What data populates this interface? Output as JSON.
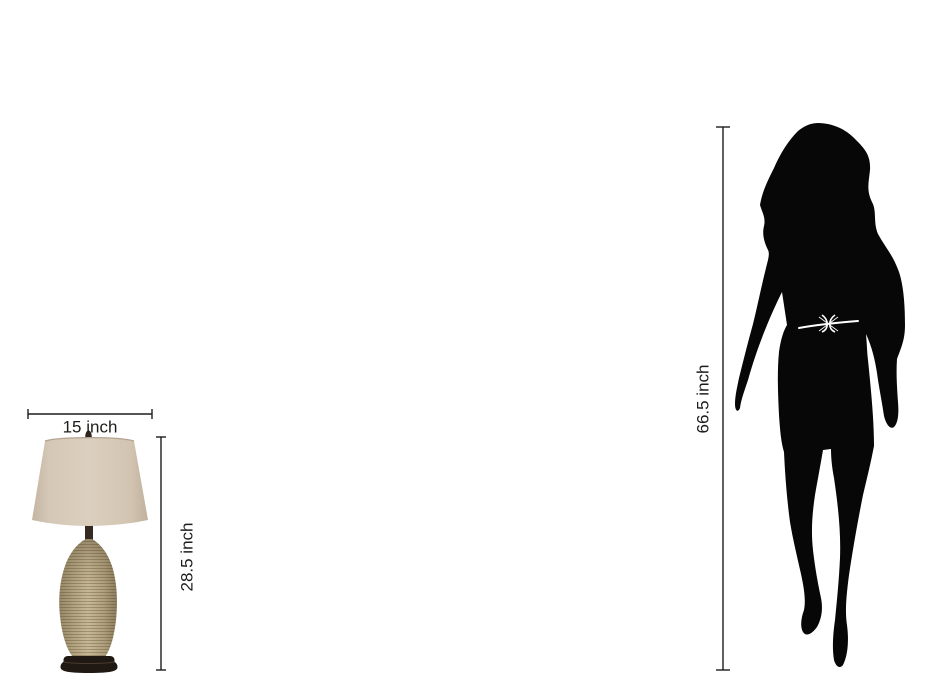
{
  "objects": {
    "lamp": {
      "name": "table-lamp"
    },
    "person": {
      "name": "woman-silhouette"
    }
  },
  "dimensions": {
    "lamp_width": "15 inch",
    "lamp_height": "28.5 inch",
    "person_height": "66.5 inch"
  },
  "colors": {
    "background": "#ffffff",
    "line": "#1d1d1b",
    "text": "#1d1d1b",
    "silhouette": "#070707",
    "belt": "#ffffff",
    "shade_base": "#d5c8b6",
    "ceramic_base": "#b2a37f",
    "foot": "#201913",
    "finial": "#30261d"
  }
}
